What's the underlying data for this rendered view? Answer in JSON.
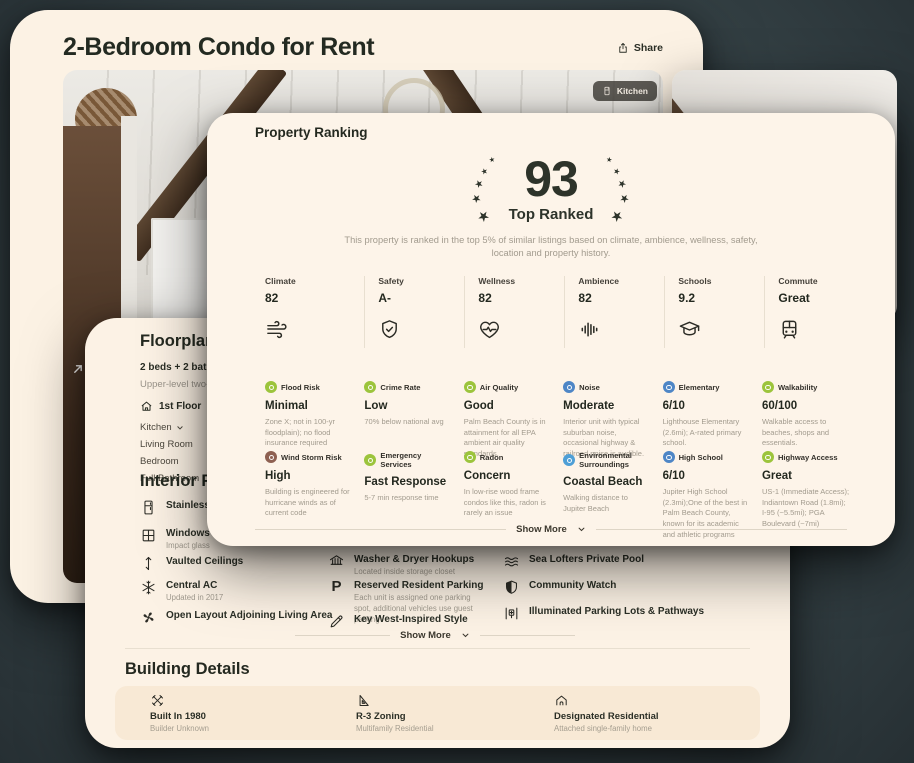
{
  "page": {
    "title": "2-Bedroom Condo for Rent",
    "share_label": "Share",
    "photo_tag": "Kitchen"
  },
  "ranking": {
    "heading": "Property Ranking",
    "score": "93",
    "score_label": "Top Ranked",
    "description": "This property is ranked in the top 5% of similar listings based on climate, ambience, wellness, safety, location and property history.",
    "categories": [
      {
        "label": "Climate",
        "value": "82",
        "icon": "wind"
      },
      {
        "label": "Safety",
        "value": "A-",
        "icon": "shield-check"
      },
      {
        "label": "Wellness",
        "value": "82",
        "icon": "heart-pulse"
      },
      {
        "label": "Ambience",
        "value": "82",
        "icon": "waveform"
      },
      {
        "label": "Schools",
        "value": "9.2",
        "icon": "graduation-cap"
      },
      {
        "label": "Commute",
        "value": "Great",
        "icon": "train"
      }
    ],
    "details": [
      {
        "label": "Flood Risk",
        "value": "Minimal",
        "desc": "Zone X; not in 100-yr floodplain); no flood insurance required",
        "color": "#9cc43c"
      },
      {
        "label": "Crime Rate",
        "value": "Low",
        "desc": "70% below national avg",
        "color": "#9cc43c"
      },
      {
        "label": "Air Quality",
        "value": "Good",
        "desc": "Palm Beach County is in attainment for all EPA ambient air quality standards.",
        "color": "#9cc43c"
      },
      {
        "label": "Noise",
        "value": "Moderate",
        "desc": "Interior unit with typical suburban noise, occasional highway & railroad noise is audible.",
        "color": "#4e86c6"
      },
      {
        "label": "Elementary",
        "value": "6/10",
        "desc": "Lighthouse Elementary (2.6mi); A-rated primary school.",
        "color": "#4e86c6"
      },
      {
        "label": "Walkability",
        "value": "60/100",
        "desc": "Walkable access to beaches, shops and essentials.",
        "color": "#9cc43c"
      },
      {
        "label": "Wind Storm Risk",
        "value": "High",
        "desc": "Building is engineered for hurricane winds as of current code",
        "color": "#8e6051"
      },
      {
        "label": "Emergency Services",
        "value": "Fast Response",
        "desc": "5-7 min response time",
        "color": "#9cc43c"
      },
      {
        "label": "Radon",
        "value": "Concern",
        "desc": "In low-rise wood frame condos like this, radon is rarely an issue",
        "color": "#9cc43c"
      },
      {
        "label": "Environmental Surroundings",
        "value": "Coastal Beach",
        "desc": "Walking distance to Jupiter Beach",
        "color": "#4e9fd6"
      },
      {
        "label": "High School",
        "value": "6/10",
        "desc": "Jupiter High School (2.3mi);One of the best in Palm Beach County, known for its academic and athletic programs",
        "color": "#4e86c6"
      },
      {
        "label": "Highway Access",
        "value": "Great",
        "desc": "US-1 (Immediate Access); Indiantown Road (1.8mi); I-95 (~5.5mi); PGA Boulevard (~7mi)",
        "color": "#9cc43c"
      }
    ],
    "show_more_label": "Show More"
  },
  "floorplan": {
    "heading": "Floorplan",
    "beds_baths": "2 beds  +  2 baths",
    "subtitle": "Upper-level two-bedroom",
    "floor_label": "1st Floor",
    "rooms": [
      "Kitchen",
      "Living Room",
      "Bedroom",
      "Full Bathroom"
    ]
  },
  "interior": {
    "heading": "Interior Features",
    "col1": [
      {
        "label": "Stainless Steel",
        "sub": ""
      },
      {
        "label": "Windows",
        "sub": "Impact glass"
      },
      {
        "label": "Vaulted Ceilings",
        "sub": ""
      },
      {
        "label": "Central AC",
        "sub": "Updated in 2017"
      },
      {
        "label": "Open Layout Adjoining Living Area",
        "sub": ""
      }
    ],
    "col2": [
      {
        "label": "Washer & Dryer Hookups",
        "sub": "Located inside storage closet"
      },
      {
        "label": "Reserved Resident Parking",
        "sub": "Each unit is assigned one parking spot, additional vehicles use guest parking"
      },
      {
        "label": "Key West-Inspired Style",
        "sub": ""
      }
    ],
    "col3": [
      "Sea Lofters Private Pool",
      "Community Watch",
      "Illuminated Parking Lots & Pathways"
    ],
    "show_more_label": "Show More"
  },
  "building": {
    "heading": "Building Details",
    "items": [
      {
        "label": "Built In 1980",
        "sub": "Builder Unknown"
      },
      {
        "label": "R-3 Zoning",
        "sub": "Multifamily Residential"
      },
      {
        "label": "Designated Residential",
        "sub": "Attached single-family home"
      }
    ]
  }
}
